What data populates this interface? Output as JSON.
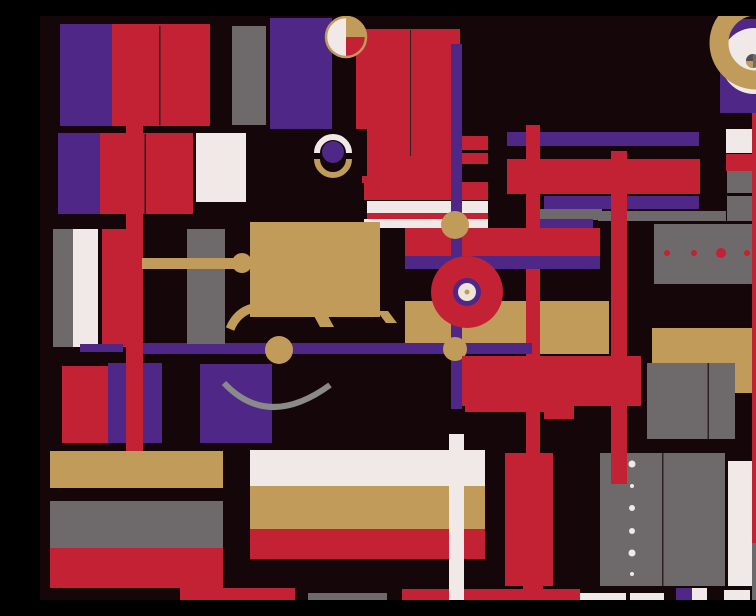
{
  "title": "Abstract geometric composition — crimson, purple, gold and gray blocks, bars, circles and arcs on a black ground",
  "canvas": {
    "width": 756,
    "height": 584,
    "background": "#150609"
  },
  "palette": {
    "black": "#150609",
    "red": "#C32134",
    "purple": "#4E2787",
    "gold": "#C19B59",
    "gray": "#6E6A6B",
    "gray_light": "#8A8A8A",
    "gray_deep": "#54504F",
    "white": "#F1E8E8",
    "cream": "#EDE4DA",
    "seam": "#2E2024"
  },
  "shapes": [
    {
      "name": "purple-rect-topleft",
      "type": "rect",
      "x": 20,
      "y": 8,
      "w": 52,
      "h": 102,
      "color": "purple"
    },
    {
      "name": "red-rect-topleft",
      "type": "rect",
      "x": 72,
      "y": 8,
      "w": 98,
      "h": 102,
      "color": "red"
    },
    {
      "name": "seam-red-topleft",
      "type": "rect",
      "x": 119,
      "y": 10,
      "w": 1.5,
      "h": 99,
      "color": "seam"
    },
    {
      "name": "gray-rect-topleft",
      "type": "rect",
      "x": 192,
      "y": 10,
      "w": 34,
      "h": 99,
      "color": "gray"
    },
    {
      "name": "purple-column-top",
      "type": "rect",
      "x": 230,
      "y": 2,
      "w": 62,
      "h": 111,
      "color": "purple"
    },
    {
      "name": "purple-block-left2",
      "type": "rect",
      "x": 18,
      "y": 117,
      "w": 42,
      "h": 81,
      "color": "purple"
    },
    {
      "name": "red-block-left2",
      "type": "rect",
      "x": 60,
      "y": 117,
      "w": 93,
      "h": 81,
      "color": "red"
    },
    {
      "name": "seam-red-left2",
      "type": "rect",
      "x": 104.5,
      "y": 118,
      "w": 1.5,
      "h": 80,
      "color": "seam"
    },
    {
      "name": "white-column-left2",
      "type": "rect",
      "x": 156,
      "y": 117,
      "w": 50,
      "h": 69,
      "color": "white"
    },
    {
      "name": "red-big-rect-top",
      "type": "rect",
      "x": 316,
      "y": 13,
      "w": 104,
      "h": 130,
      "color": "red"
    },
    {
      "name": "seam-red-big",
      "type": "rect",
      "x": 370,
      "y": 14,
      "w": 1,
      "h": 126,
      "color": "seam"
    },
    {
      "name": "red-step-mid",
      "type": "rect",
      "x": 322,
      "y": 140,
      "w": 98,
      "h": 27,
      "color": "red"
    },
    {
      "name": "red-step-low",
      "type": "rect",
      "x": 324,
      "y": 166,
      "w": 124,
      "h": 18,
      "color": "red"
    },
    {
      "name": "black-notch-square",
      "type": "rect",
      "x": 275,
      "y": 113,
      "w": 52,
      "h": 47,
      "color": "black"
    },
    {
      "name": "white-strip-upper",
      "type": "rect",
      "x": 327,
      "y": 185,
      "w": 121,
      "h": 12,
      "color": "white"
    },
    {
      "name": "red-strip-between",
      "type": "rect",
      "x": 327,
      "y": 197,
      "w": 121,
      "h": 6,
      "color": "red"
    },
    {
      "name": "white-strip-lower",
      "type": "rect",
      "x": 324,
      "y": 203,
      "w": 124,
      "h": 9,
      "color": "white"
    },
    {
      "name": "red-field-center",
      "type": "rect",
      "x": 365,
      "y": 212,
      "w": 195,
      "h": 28,
      "color": "red"
    },
    {
      "name": "gray-strip-topright-a",
      "type": "rect",
      "x": 500,
      "y": 193,
      "w": 62,
      "h": 11,
      "color": "gray"
    },
    {
      "name": "gray-strip-topright-b",
      "type": "rect",
      "x": 558,
      "y": 195,
      "w": 128,
      "h": 10,
      "color": "gray"
    },
    {
      "name": "purple-strip-topright",
      "type": "rect",
      "x": 500,
      "y": 203,
      "w": 53,
      "h": 9,
      "color": "purple"
    },
    {
      "name": "purple-hbar-upper",
      "type": "rect",
      "x": 467,
      "y": 116,
      "w": 192,
      "h": 14,
      "color": "purple"
    },
    {
      "name": "red-hbar-upper",
      "type": "rect",
      "x": 467,
      "y": 143,
      "w": 193,
      "h": 35,
      "color": "red"
    },
    {
      "name": "purple-hbar-mid",
      "type": "rect",
      "x": 504,
      "y": 180,
      "w": 155,
      "h": 13,
      "color": "purple"
    },
    {
      "name": "gold-band-center",
      "type": "rect",
      "x": 365,
      "y": 285,
      "w": 204,
      "h": 53,
      "color": "gold"
    },
    {
      "name": "red-vbar-central",
      "type": "rect",
      "x": 486,
      "y": 109,
      "w": 14,
      "h": 328,
      "color": "red"
    },
    {
      "name": "purple-hbar-center",
      "type": "rect",
      "x": 365,
      "y": 240,
      "w": 195,
      "h": 13,
      "color": "purple"
    },
    {
      "name": "purple-vbar-center",
      "type": "rect",
      "x": 411,
      "y": 28,
      "w": 11,
      "h": 365,
      "color": "purple"
    },
    {
      "name": "small-red-rect-1",
      "type": "rect",
      "x": 422,
      "y": 120,
      "w": 26,
      "h": 14,
      "color": "red"
    },
    {
      "name": "small-red-rect-2",
      "type": "rect",
      "x": 422,
      "y": 137,
      "w": 26,
      "h": 11,
      "color": "red"
    },
    {
      "name": "gold-circle-on-vbar-top",
      "type": "circle",
      "cx": 415,
      "cy": 209,
      "r": 14,
      "color": "gold"
    },
    {
      "name": "red-circle-large",
      "type": "circle",
      "cx": 427,
      "cy": 276,
      "r": 36,
      "color": "red"
    },
    {
      "name": "purple-ring-center",
      "type": "circle",
      "cx": 427,
      "cy": 276,
      "r": 14,
      "color": "purple"
    },
    {
      "name": "cream-circle-center",
      "type": "circle",
      "cx": 427,
      "cy": 276,
      "r": 9,
      "color": "cream"
    },
    {
      "name": "gold-dot-center",
      "type": "circle",
      "cx": 427,
      "cy": 276,
      "r": 2.5,
      "color": "gold"
    },
    {
      "name": "gray-dots-rect",
      "type": "rect",
      "x": 614,
      "y": 208,
      "w": 131,
      "h": 60,
      "color": "gray"
    },
    {
      "name": "red-dot-1",
      "type": "circle",
      "cx": 627,
      "cy": 237,
      "r": 3,
      "color": "red"
    },
    {
      "name": "red-dot-2",
      "type": "circle",
      "cx": 654,
      "cy": 237,
      "r": 3,
      "color": "red"
    },
    {
      "name": "red-dot-3",
      "type": "circle",
      "cx": 681,
      "cy": 237,
      "r": 5,
      "color": "red"
    },
    {
      "name": "red-dot-4",
      "type": "circle",
      "cx": 707,
      "cy": 237,
      "r": 3,
      "color": "red"
    },
    {
      "name": "red-dot-5",
      "type": "circle",
      "cx": 734,
      "cy": 237,
      "r": 3,
      "color": "red"
    },
    {
      "name": "gray-column-left",
      "type": "rect",
      "x": 13,
      "y": 213,
      "w": 20,
      "h": 118,
      "color": "gray"
    },
    {
      "name": "white-column-left",
      "type": "rect",
      "x": 33,
      "y": 213,
      "w": 25,
      "h": 118,
      "color": "white"
    },
    {
      "name": "red-column-left",
      "type": "rect",
      "x": 62,
      "y": 213,
      "w": 24,
      "h": 118,
      "color": "red"
    },
    {
      "name": "red-square-bottomleft",
      "type": "rect",
      "x": 22,
      "y": 350,
      "w": 46,
      "h": 77,
      "color": "red"
    },
    {
      "name": "purple-block-bottomleft-1",
      "type": "rect",
      "x": 68,
      "y": 347,
      "w": 54,
      "h": 80,
      "color": "purple"
    },
    {
      "name": "purple-block-bottomleft-2",
      "type": "rect",
      "x": 160,
      "y": 348,
      "w": 72,
      "h": 79,
      "color": "purple"
    },
    {
      "name": "purple-hbar-left-piece",
      "type": "rect",
      "x": 40,
      "y": 328,
      "w": 43,
      "h": 8,
      "color": "purple"
    },
    {
      "name": "purple-hbar-long",
      "type": "rect",
      "x": 103,
      "y": 327,
      "w": 389,
      "h": 11,
      "color": "purple"
    },
    {
      "name": "red-vbar-left-long",
      "type": "rect",
      "x": 86,
      "y": 110,
      "w": 17,
      "h": 328,
      "color": "red"
    },
    {
      "name": "gray-column-mid",
      "type": "rect",
      "x": 147,
      "y": 213,
      "w": 38,
      "h": 115,
      "color": "gray"
    },
    {
      "name": "gold-arm-bar",
      "type": "rect",
      "x": 102,
      "y": 242,
      "w": 93,
      "h": 11,
      "color": "gold"
    },
    {
      "name": "gold-arm-knob",
      "type": "circle",
      "cx": 202,
      "cy": 247,
      "r": 10,
      "color": "gold"
    },
    {
      "name": "gold-rect-large",
      "type": "rect",
      "x": 210,
      "y": 206,
      "w": 130,
      "h": 95,
      "color": "gold"
    },
    {
      "name": "gold-leg-curve",
      "type": "path",
      "d": "M 213 292 Q 197 296 190 313",
      "stroke": "gold",
      "strokeWidth": 9,
      "linecap": "butt"
    },
    {
      "name": "gold-tail-mid",
      "type": "polygon",
      "points": "274,300 288,300 294,311 280,311",
      "color": "gold"
    },
    {
      "name": "gold-tail-right",
      "type": "polygon",
      "points": "337,295 348,295 357,307 346,307",
      "color": "gold"
    },
    {
      "name": "gold-circle-on-hbar",
      "type": "circle",
      "cx": 239,
      "cy": 334,
      "r": 14,
      "color": "gold"
    },
    {
      "name": "gold-circle-on-vbar-low",
      "type": "circle",
      "cx": 415,
      "cy": 333,
      "r": 12,
      "color": "gold"
    },
    {
      "name": "smile-arc",
      "type": "path",
      "d": "M 184 367 Q 228 414 290 369",
      "stroke": "gray_light",
      "strokeWidth": 6,
      "linecap": "butt"
    },
    {
      "name": "red-block-midright",
      "type": "rect",
      "x": 422,
      "y": 340,
      "w": 179,
      "h": 50,
      "color": "red"
    },
    {
      "name": "red-piece-below",
      "type": "rect",
      "x": 504,
      "y": 390,
      "w": 30,
      "h": 13,
      "color": "red"
    },
    {
      "name": "red-strip-thin-mid",
      "type": "rect",
      "x": 425,
      "y": 390,
      "w": 79,
      "h": 6,
      "color": "red"
    },
    {
      "name": "red-block-low",
      "type": "rect",
      "x": 465,
      "y": 437,
      "w": 48,
      "h": 133,
      "color": "red"
    },
    {
      "name": "red-tab-low",
      "type": "rect",
      "x": 483,
      "y": 568,
      "w": 20,
      "h": 5,
      "color": "red"
    },
    {
      "name": "gold-bar-bottomleft",
      "type": "rect",
      "x": 10,
      "y": 435,
      "w": 173,
      "h": 37,
      "color": "gold"
    },
    {
      "name": "gray-bar-bottomleft",
      "type": "rect",
      "x": 10,
      "y": 485,
      "w": 173,
      "h": 47,
      "color": "gray"
    },
    {
      "name": "red-bar-bottomleft",
      "type": "rect",
      "x": 10,
      "y": 532,
      "w": 173,
      "h": 40,
      "color": "red"
    },
    {
      "name": "red-strip-bottom-1",
      "type": "rect",
      "x": 140,
      "y": 572,
      "w": 115,
      "h": 12,
      "color": "red"
    },
    {
      "name": "gray-strip-bottom",
      "type": "rect",
      "x": 268,
      "y": 577,
      "w": 79,
      "h": 7,
      "color": "gray"
    },
    {
      "name": "white-band-bottom",
      "type": "rect",
      "x": 210,
      "y": 434,
      "w": 235,
      "h": 36,
      "color": "white"
    },
    {
      "name": "gold-band-bottom",
      "type": "rect",
      "x": 210,
      "y": 470,
      "w": 235,
      "h": 43,
      "color": "gold"
    },
    {
      "name": "red-band-bottom",
      "type": "rect",
      "x": 210,
      "y": 513,
      "w": 235,
      "h": 30,
      "color": "red"
    },
    {
      "name": "red-strip-bottom-2",
      "type": "rect",
      "x": 362,
      "y": 573,
      "w": 178,
      "h": 11,
      "color": "red"
    },
    {
      "name": "white-vbar",
      "type": "rect",
      "x": 409,
      "y": 418,
      "w": 15,
      "h": 166,
      "color": "white"
    },
    {
      "name": "white-piece-bottom-1",
      "type": "rect",
      "x": 540,
      "y": 577,
      "w": 46,
      "h": 7,
      "color": "white"
    },
    {
      "name": "white-piece-bottom-2",
      "type": "rect",
      "x": 590,
      "y": 577,
      "w": 34,
      "h": 7,
      "color": "white"
    },
    {
      "name": "purple-piece-bottom",
      "type": "rect",
      "x": 636,
      "y": 572,
      "w": 16,
      "h": 12,
      "color": "purple"
    },
    {
      "name": "white-piece-bottom-3",
      "type": "rect",
      "x": 652,
      "y": 572,
      "w": 15,
      "h": 12,
      "color": "white"
    },
    {
      "name": "white-piece-bottom-4",
      "type": "rect",
      "x": 684,
      "y": 574,
      "w": 26,
      "h": 10,
      "color": "white"
    },
    {
      "name": "gold-rect-right",
      "type": "rect",
      "x": 612,
      "y": 312,
      "w": 138,
      "h": 65,
      "color": "gold"
    },
    {
      "name": "gray-pair-right-1",
      "type": "rect",
      "x": 607,
      "y": 347,
      "w": 61,
      "h": 76,
      "color": "gray"
    },
    {
      "name": "gray-pair-right-2",
      "type": "rect",
      "x": 668,
      "y": 347,
      "w": 27,
      "h": 76,
      "color": "gray"
    },
    {
      "name": "seam-gray-pair",
      "type": "rect",
      "x": 667.5,
      "y": 347,
      "w": 1.5,
      "h": 76,
      "color": "seam"
    },
    {
      "name": "gray-big-rect-1",
      "type": "rect",
      "x": 560,
      "y": 437,
      "w": 62,
      "h": 133,
      "color": "gray"
    },
    {
      "name": "gray-big-rect-2",
      "type": "rect",
      "x": 623,
      "y": 437,
      "w": 62,
      "h": 133,
      "color": "gray"
    },
    {
      "name": "seam-gray-big",
      "type": "rect",
      "x": 622,
      "y": 437,
      "w": 1.5,
      "h": 133,
      "color": "seam"
    },
    {
      "name": "white-dot-1",
      "type": "circle",
      "cx": 592,
      "cy": 448,
      "r": 3.5,
      "color": "white"
    },
    {
      "name": "white-dot-2",
      "type": "circle",
      "cx": 592,
      "cy": 470,
      "r": 2,
      "color": "white"
    },
    {
      "name": "white-dot-3",
      "type": "circle",
      "cx": 592,
      "cy": 492,
      "r": 3,
      "color": "white"
    },
    {
      "name": "white-dot-4",
      "type": "circle",
      "cx": 592,
      "cy": 515,
      "r": 3,
      "color": "white"
    },
    {
      "name": "white-dot-5",
      "type": "circle",
      "cx": 592,
      "cy": 537,
      "r": 3.5,
      "color": "white"
    },
    {
      "name": "white-dot-6",
      "type": "circle",
      "cx": 592,
      "cy": 558,
      "r": 2,
      "color": "white"
    },
    {
      "name": "red-vbar-right-center",
      "type": "rect",
      "x": 571,
      "y": 135,
      "w": 16,
      "h": 333,
      "color": "red"
    },
    {
      "name": "red-extra-right",
      "type": "rect",
      "x": 730,
      "y": 388,
      "w": 15,
      "h": 35,
      "color": "red"
    },
    {
      "name": "white-piece-right",
      "type": "rect",
      "x": 730,
      "y": 445,
      "w": 20,
      "h": 12,
      "color": "white"
    },
    {
      "name": "white-column-right",
      "type": "rect",
      "x": 688,
      "y": 445,
      "w": 24,
      "h": 125,
      "color": "white"
    },
    {
      "name": "white-rect-topright",
      "type": "rect",
      "x": 686,
      "y": 113,
      "w": 70,
      "h": 24,
      "color": "white"
    },
    {
      "name": "red-hbar-topright",
      "type": "rect",
      "x": 686,
      "y": 138,
      "w": 70,
      "h": 17,
      "color": "red"
    },
    {
      "name": "gray-block-topright-1",
      "type": "rect",
      "x": 687,
      "y": 155,
      "w": 69,
      "h": 22,
      "color": "gray"
    },
    {
      "name": "gray-block-topright-2",
      "type": "rect",
      "x": 687,
      "y": 180,
      "w": 69,
      "h": 25,
      "color": "gray"
    },
    {
      "name": "small-red-topright",
      "type": "rect",
      "x": 735,
      "y": 94,
      "w": 20,
      "h": 7,
      "color": "red"
    },
    {
      "name": "red-vbar-far-right",
      "type": "rect",
      "x": 712,
      "y": 97,
      "w": 18,
      "h": 430,
      "color": "red"
    },
    {
      "name": "gray-below-red-vbar",
      "type": "rect",
      "x": 712,
      "y": 527,
      "w": 18,
      "h": 57,
      "color": "gray"
    },
    {
      "name": "gold-column-right",
      "type": "rect",
      "x": 734,
      "y": 457,
      "w": 22,
      "h": 113,
      "color": "gold"
    },
    {
      "name": "sliver-red-edge-1",
      "type": "rect",
      "x": 752,
      "y": 340,
      "w": 4,
      "h": 55,
      "color": "red"
    },
    {
      "name": "sliver-purple-edge",
      "type": "rect",
      "x": 752,
      "y": 397,
      "w": 4,
      "h": 26,
      "color": "purple"
    },
    {
      "name": "sliver-red-edge-2",
      "type": "rect",
      "x": 752,
      "y": 425,
      "w": 4,
      "h": 18,
      "color": "red"
    },
    {
      "name": "purple-square-topright",
      "type": "rect",
      "x": 680,
      "y": 3,
      "w": 74,
      "h": 94,
      "color": "purple"
    },
    {
      "name": "white-circle-topright",
      "type": "circle",
      "cx": 714,
      "cy": 45,
      "r": 33,
      "color": "white"
    },
    {
      "name": "gold-crescent",
      "type": "path",
      "d": "M 716 -10 A 37 37 0 0 0 716 64",
      "stroke": "gold",
      "strokeWidth": 19,
      "linecap": "butt"
    },
    {
      "name": "mini-circle-base",
      "type": "circle",
      "cx": 713,
      "cy": 45,
      "r": 7,
      "color": "gray"
    },
    {
      "name": "mini-circle-dark-wedge",
      "type": "path",
      "d": "M 713 45 L 713 38 A 7 7 0 0 0 706 45 Z",
      "fill": "gray_deep"
    },
    {
      "name": "mini-circle-gold-wedge",
      "type": "path",
      "d": "M 713 45 L 706 45 A 7 7 0 0 0 713 52 Z",
      "fill": "gold"
    },
    {
      "name": "gray-circle-corner",
      "type": "circle",
      "cx": 739,
      "cy": 9,
      "r": 12,
      "color": "gray"
    },
    {
      "name": "quad-circle-base",
      "type": "circle",
      "cx": 306,
      "cy": 21,
      "r": 20,
      "color": "white"
    },
    {
      "name": "quad-circle-gold-wedge",
      "type": "path",
      "d": "M 306 21 L 306 1 A 20 20 0 0 1 326 21 Z",
      "fill": "gold"
    },
    {
      "name": "quad-circle-red-wedge",
      "type": "path",
      "d": "M 306 21 L 326 21 A 20 20 0 0 1 306 41 Z",
      "fill": "red"
    },
    {
      "name": "quad-circle-ring",
      "type": "circle",
      "cx": 306,
      "cy": 21,
      "r": 20,
      "color": "none",
      "stroke": "gold",
      "strokeWidth": 2.5
    },
    {
      "name": "ring-white-arc",
      "type": "path",
      "d": "M 277 137 A 16 16 0 0 1 309 137",
      "stroke": "white",
      "strokeWidth": 6,
      "linecap": "butt"
    },
    {
      "name": "ring-gold-arc",
      "type": "path",
      "d": "M 277 143 A 16 16 0 0 0 309 143",
      "stroke": "gold",
      "strokeWidth": 6,
      "linecap": "butt"
    },
    {
      "name": "ring-purple-circle",
      "type": "circle",
      "cx": 293,
      "cy": 136,
      "r": 11,
      "color": "purple"
    }
  ]
}
